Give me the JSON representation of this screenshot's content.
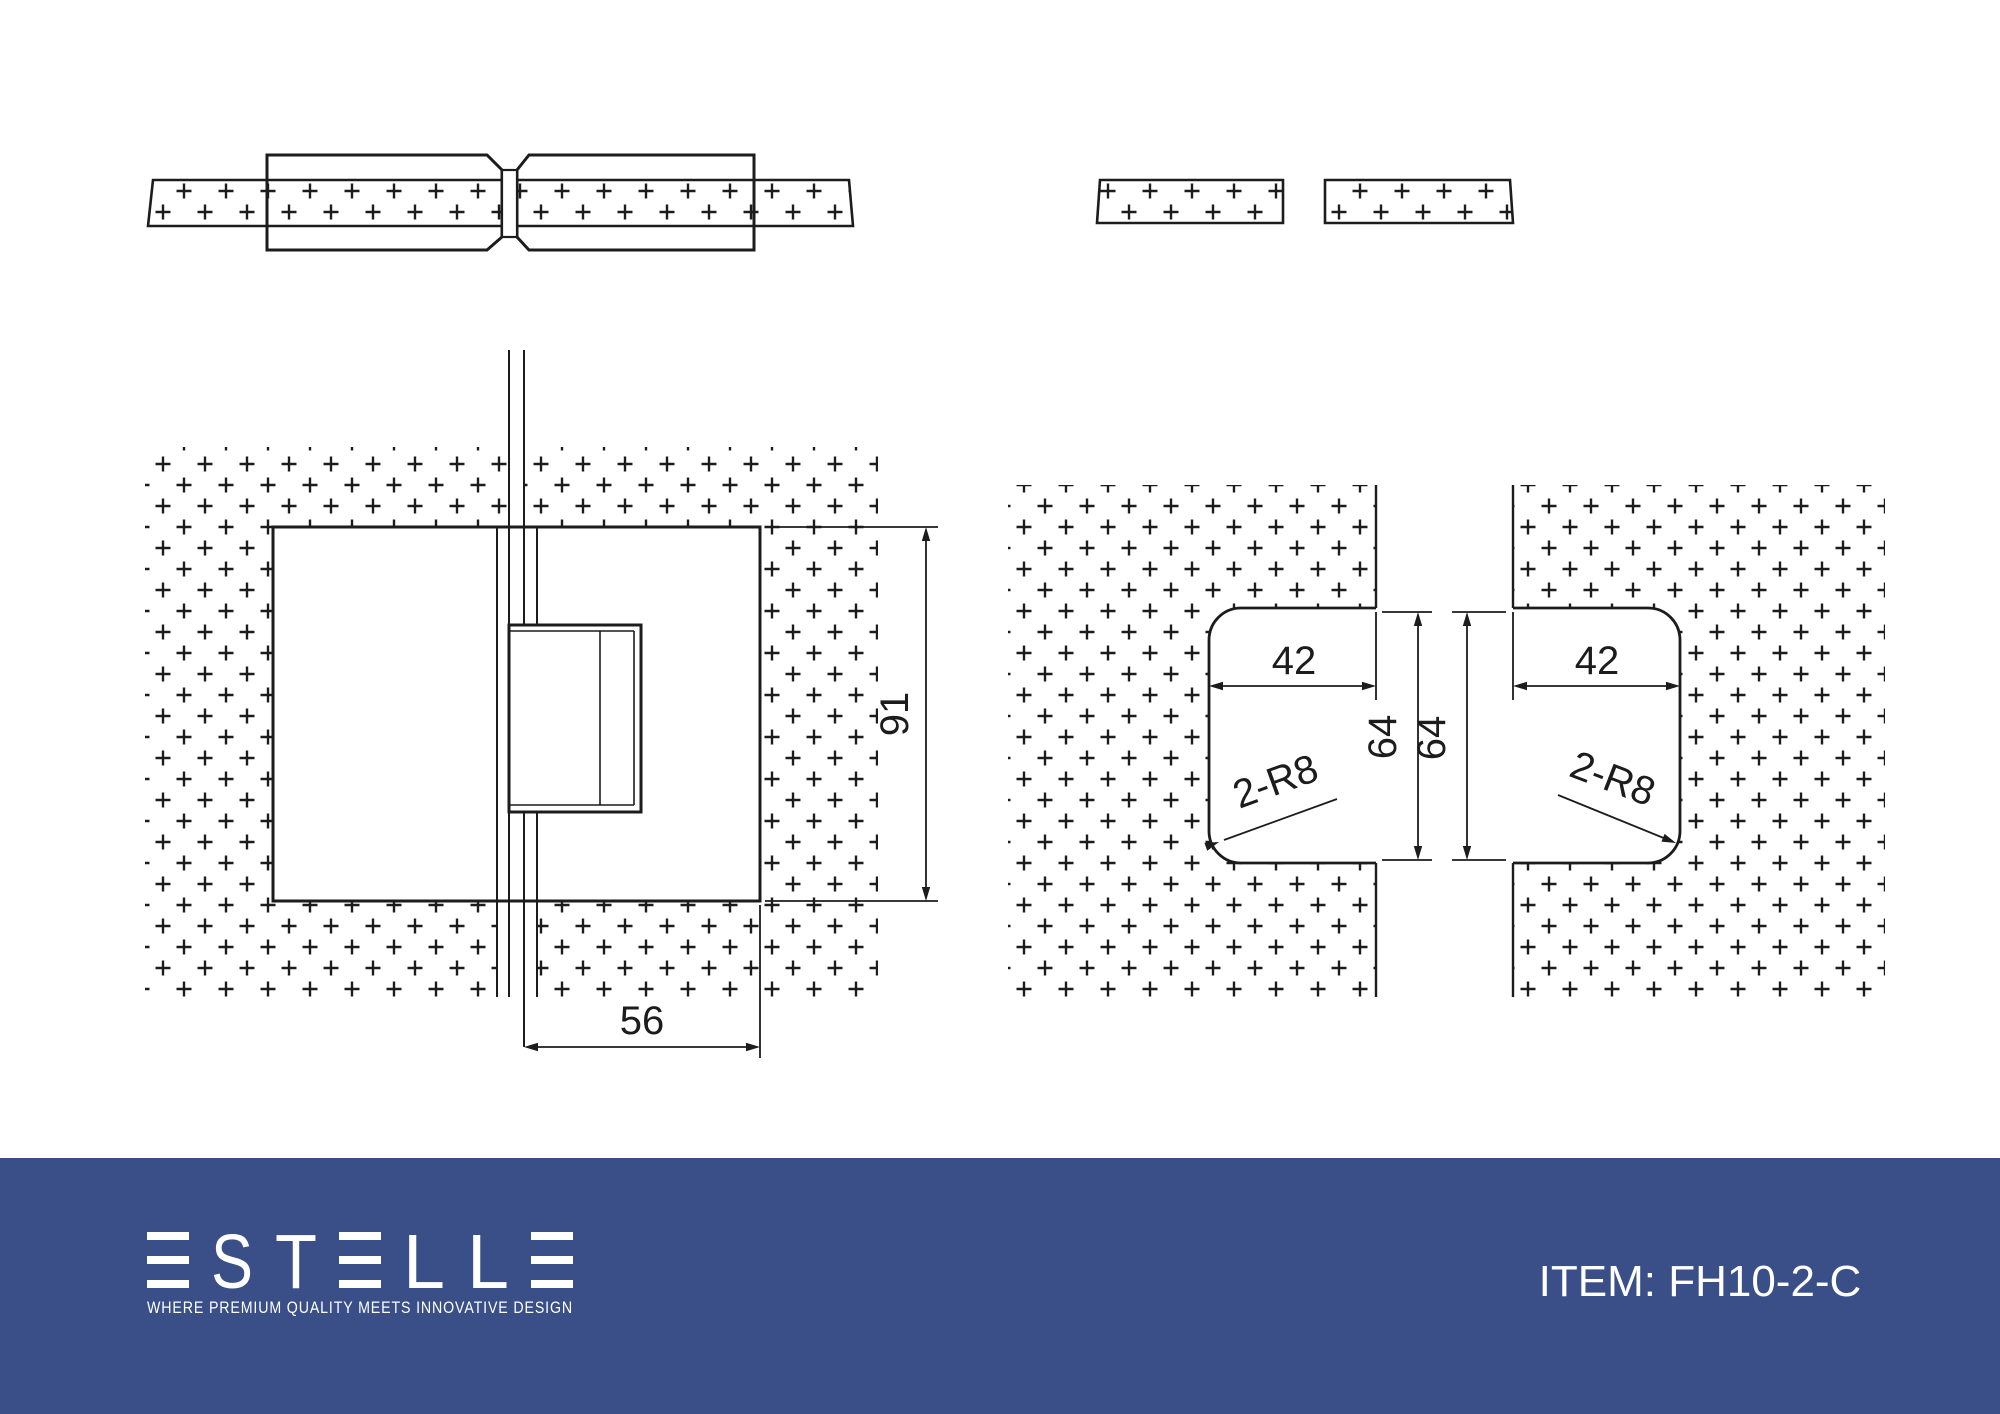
{
  "page": {
    "background": "#ffffff",
    "line_color": "#1c1c1c"
  },
  "drawing": {
    "front_view": {
      "height_label": "91",
      "width_label": "56"
    },
    "cutouts": {
      "left": {
        "width_label": "42",
        "height_label": "64",
        "radius_label": "2-R8"
      },
      "right": {
        "width_label": "42",
        "height_label": "64",
        "radius_label": "2-R8"
      }
    }
  },
  "footer": {
    "background": "#3A4E87",
    "logo": {
      "text": "ESTELLE",
      "letters": [
        "E",
        "S",
        "T",
        "E",
        "L",
        "L",
        "E"
      ]
    },
    "tagline": "WHERE PREMIUM QUALITY MEETS INNOVATIVE DESIGN",
    "item_label": "ITEM: FH10-2-C"
  }
}
